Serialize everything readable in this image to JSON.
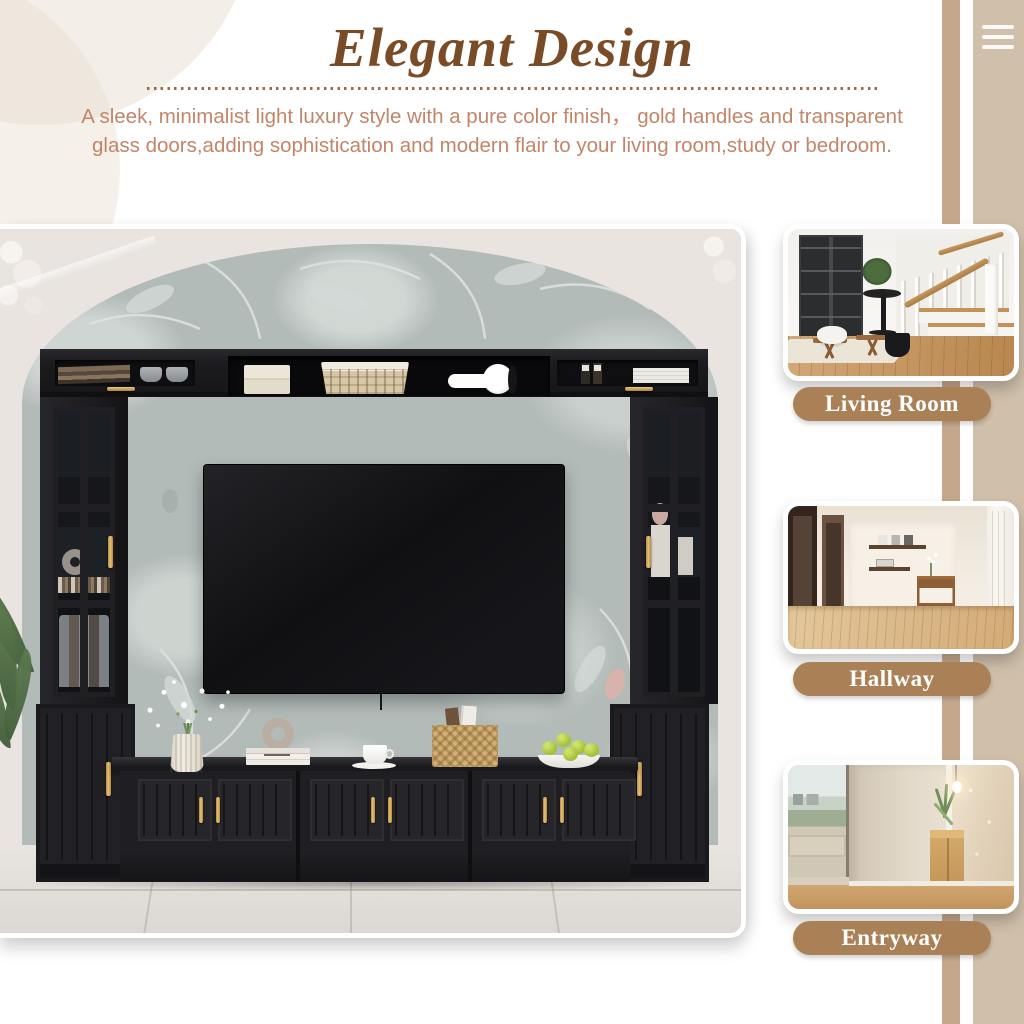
{
  "header": {
    "title": "Elegant Design",
    "description": [
      "A sleek, minimalist light luxury style with a pure color finish，  gold handles and transparent",
      "glass doors,adding sophistication and modern flair to your living room,study or bedroom."
    ]
  },
  "menu": {
    "icon": "hamburger-menu-icon"
  },
  "sidebar": {
    "rooms": [
      {
        "label": "Living Room"
      },
      {
        "label": "Hallway"
      },
      {
        "label": "Entryway"
      }
    ]
  },
  "colors": {
    "title_brown": "#7a4b27",
    "description_brown": "#c28568",
    "pill_tan": "#aa8157",
    "stripe_tan": "#c5a88c",
    "band_beige": "#cfbfab",
    "gold_handle": "#c9a257",
    "furniture_black": "#1d1d20",
    "wallpaper_gray": "#b3bbb9",
    "marble_white": "#e9e4df"
  }
}
